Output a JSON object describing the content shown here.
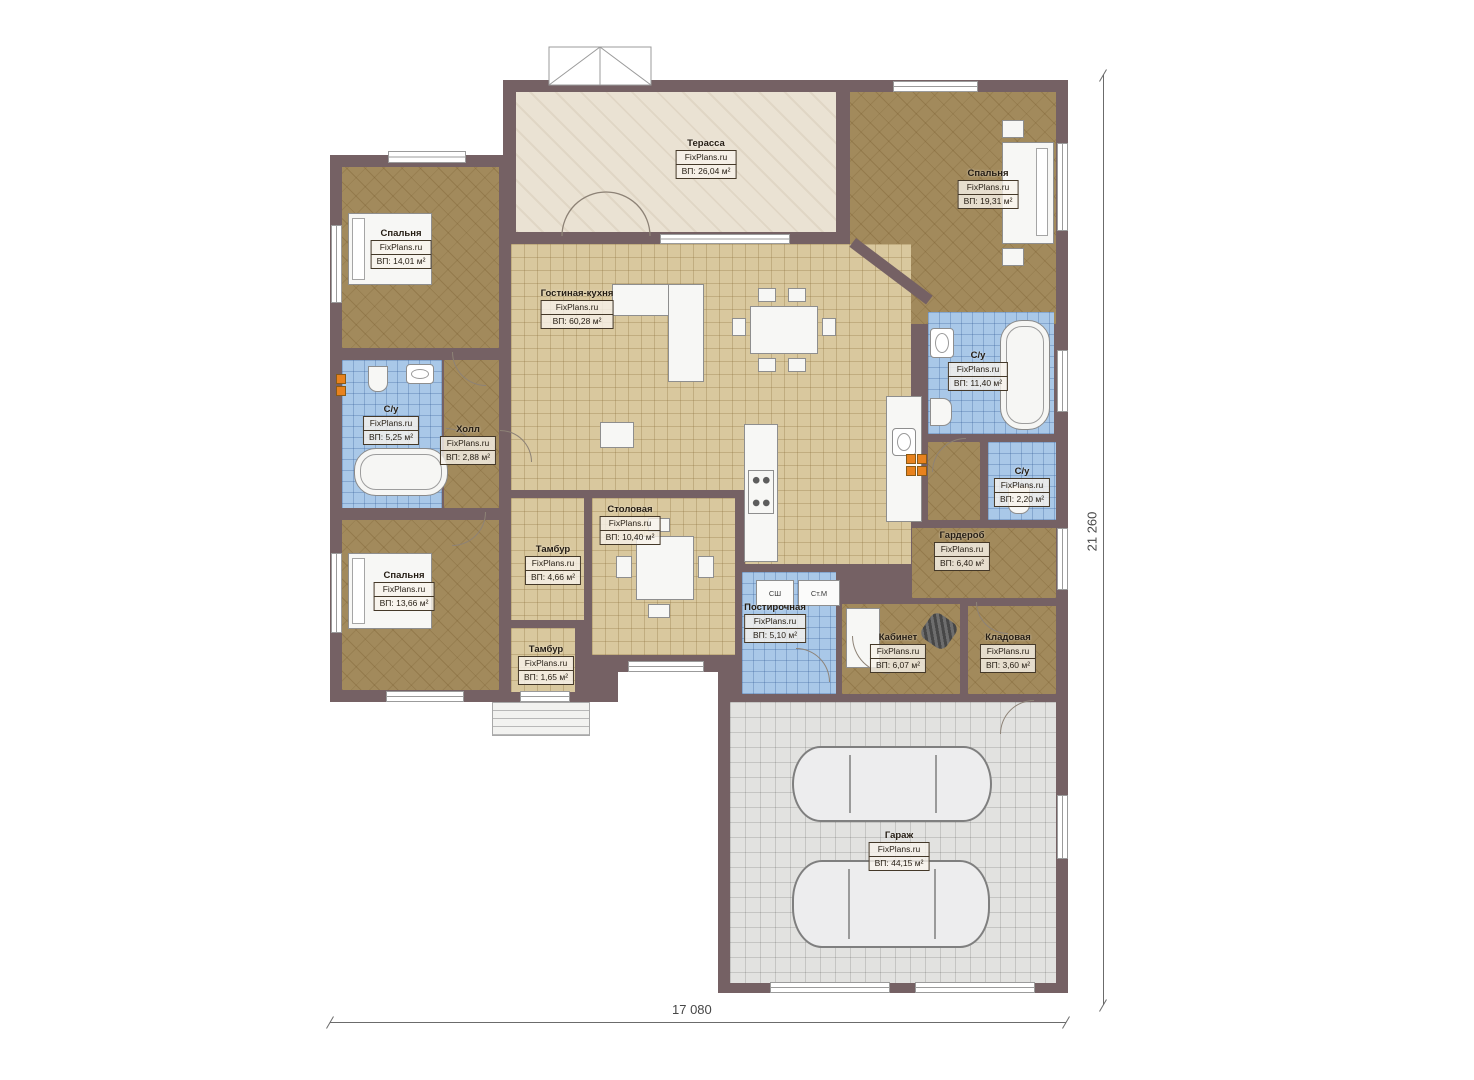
{
  "plan": {
    "watermark": "FixPlans.ru",
    "rooms": [
      {
        "name": "Терасса",
        "area": "ВП: 26,04 м²"
      },
      {
        "name": "Спальня",
        "area": "ВП: 19,31 м²"
      },
      {
        "name": "Спальня",
        "area": "ВП: 14,01 м²"
      },
      {
        "name": "Гостиная-кухня",
        "area": "ВП: 60,28 м²"
      },
      {
        "name": "С/у",
        "area": "ВП: 11,40 м²"
      },
      {
        "name": "С/у",
        "area": "ВП: 5,25 м²"
      },
      {
        "name": "Холл",
        "area": "ВП: 2,88 м²"
      },
      {
        "name": "С/у",
        "area": "ВП: 2,20 м²"
      },
      {
        "name": "Столовая",
        "area": "ВП: 10,40 м²"
      },
      {
        "name": "Тамбур",
        "area": "ВП: 4,66 м²"
      },
      {
        "name": "Гардероб",
        "area": "ВП: 6,40 м²"
      },
      {
        "name": "Спальня",
        "area": "ВП: 13,66 м²"
      },
      {
        "name": "Постирочная",
        "area": "ВП: 5,10 м²"
      },
      {
        "name": "Кабинет",
        "area": "ВП: 6,07 м²"
      },
      {
        "name": "Кладовая",
        "area": "ВП: 3,60 м²"
      },
      {
        "name": "Тамбур",
        "area": "ВП: 1,65 м²"
      },
      {
        "name": "Гараж",
        "area": "ВП: 44,15 м²"
      }
    ],
    "appliances": {
      "dryer": "СШ",
      "washer": "Ст.М"
    },
    "dimensions": {
      "width": "17 080",
      "height": "21 260"
    },
    "colors": {
      "wall": "#756164",
      "wood_floor": "#a28a5c",
      "tile_floor": "#d9c89e",
      "bath_floor": "#a9c8e8",
      "terrace_floor": "#eae2d3",
      "garage_floor": "#e2e2e0",
      "accent": "#e8821e"
    }
  }
}
